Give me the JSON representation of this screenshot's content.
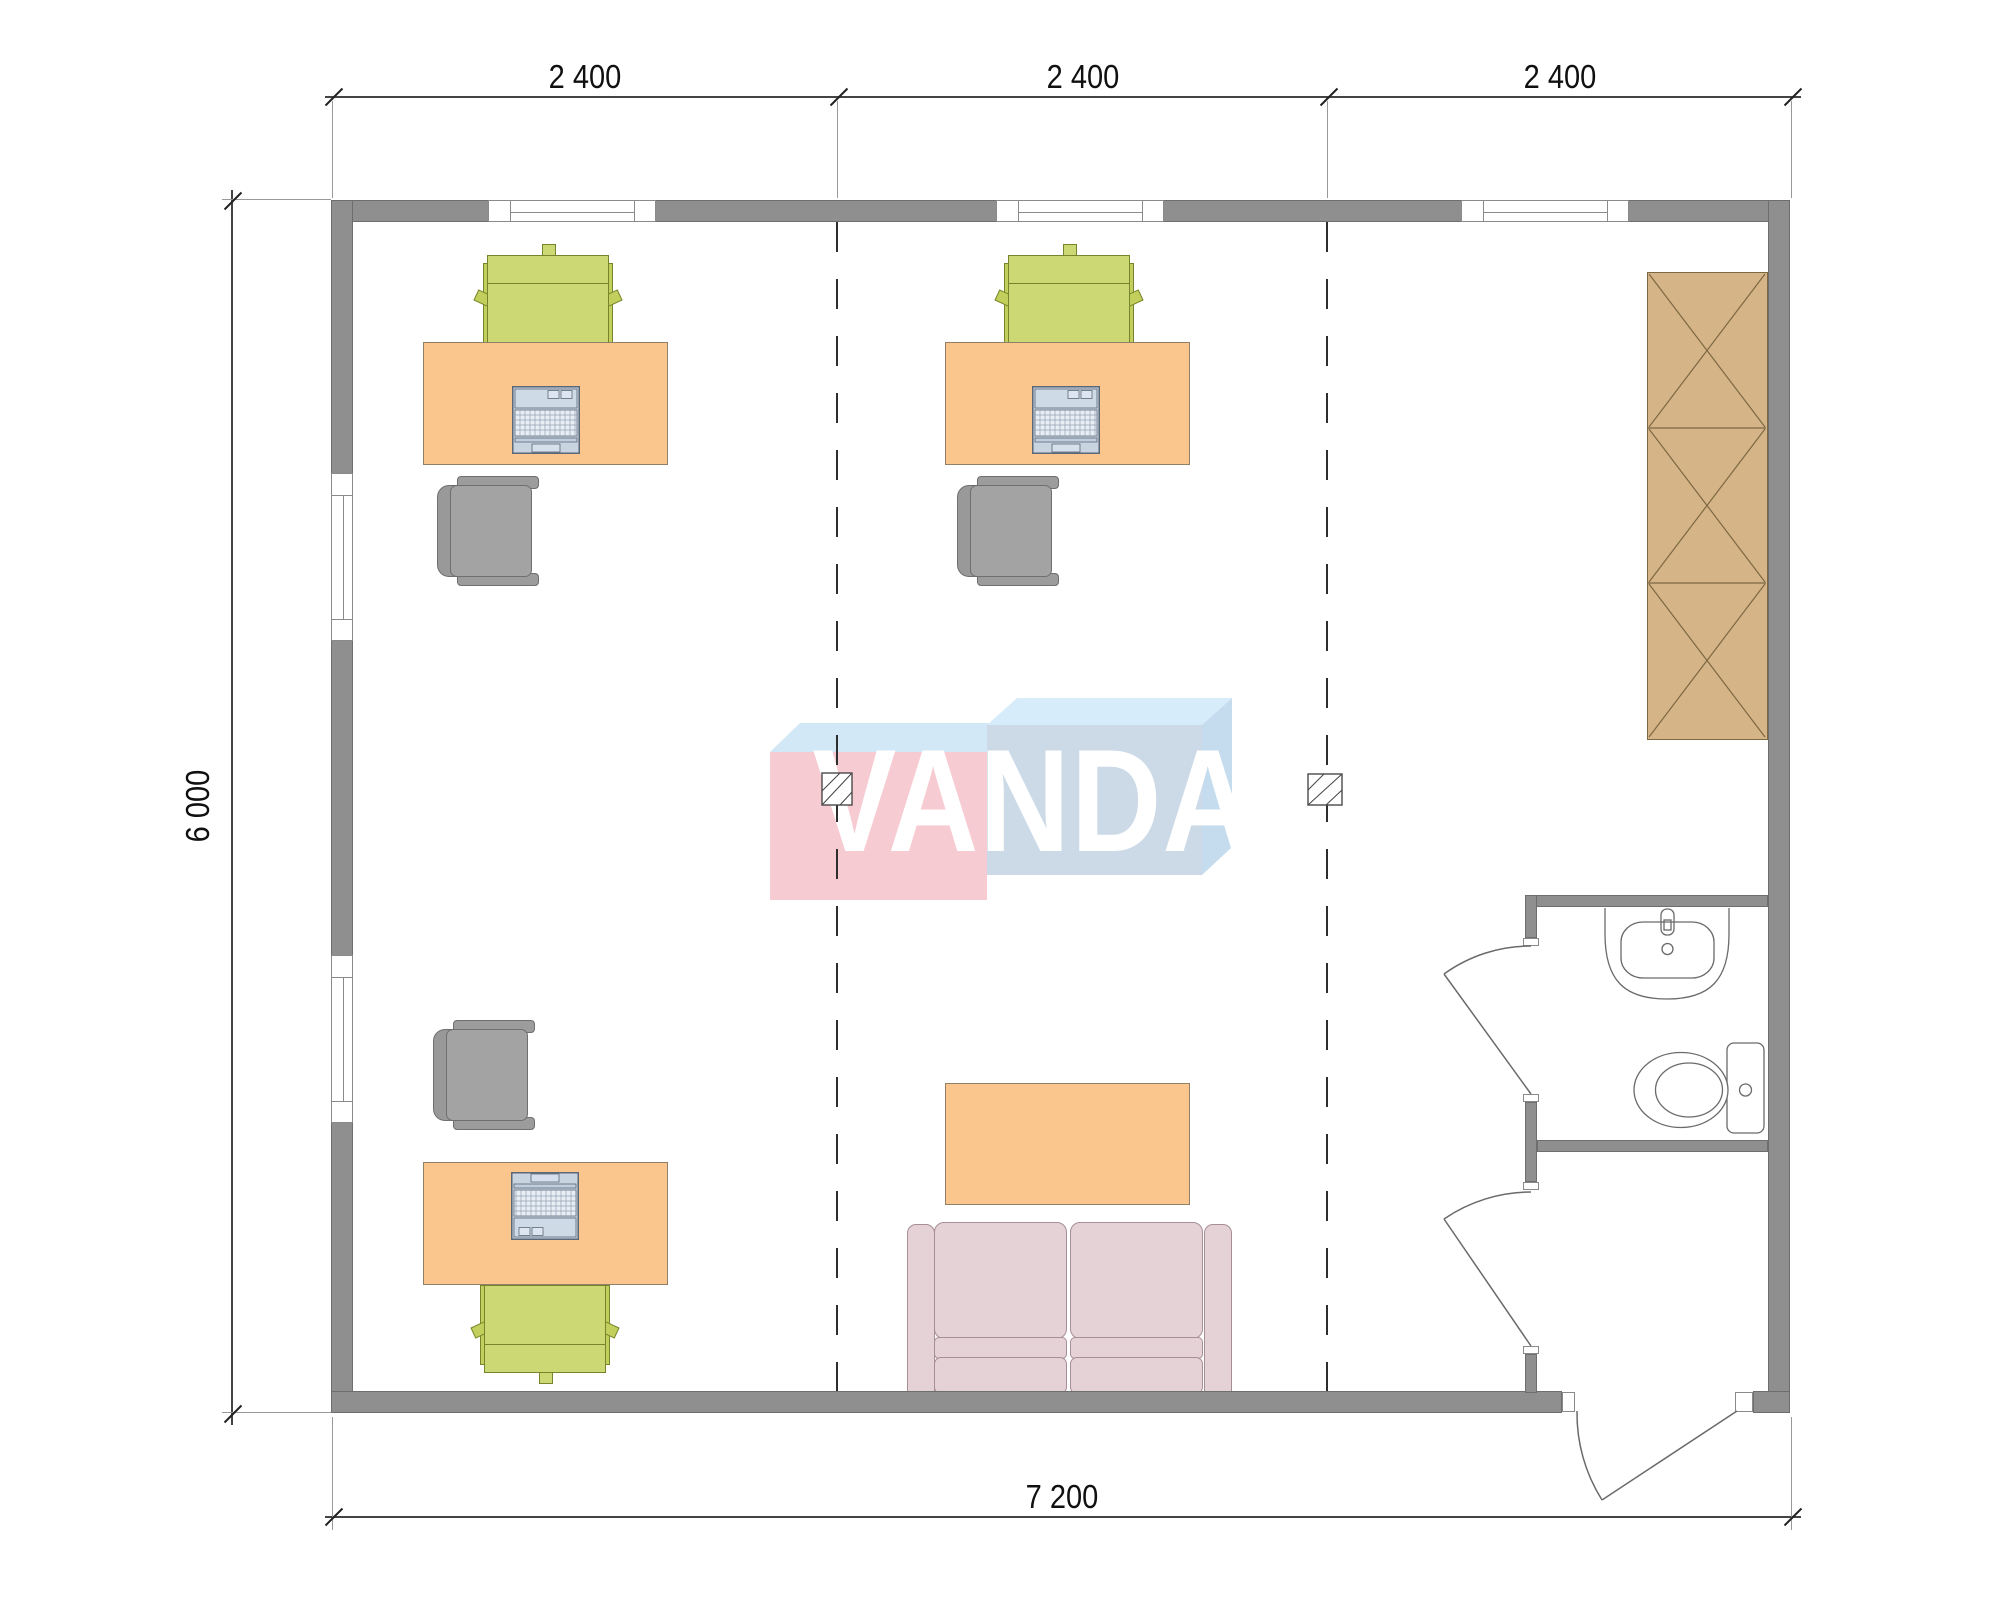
{
  "drawing": {
    "type": "floor-plan",
    "logo_text": "VANDA"
  },
  "dimensions": {
    "top": [
      {
        "label": "2 400"
      },
      {
        "label": "2 400"
      },
      {
        "label": "2 400"
      }
    ],
    "left": {
      "label": "6 000"
    },
    "bottom": {
      "label": "7 200"
    }
  },
  "symbols": [
    "desk",
    "laptop",
    "office-chair",
    "visitor-chair",
    "sofa",
    "coffee-table",
    "wardrobe",
    "sink",
    "toilet",
    "swing-door",
    "window",
    "junction-box",
    "module-grid-line"
  ],
  "colors": {
    "wall": "#8f8f8f",
    "wall-edge": "#6e6e6e",
    "window-frame": "#8a8a8a",
    "desk": "#fac68e",
    "desk-border": "#8f8066",
    "chair-green": "#ccd873",
    "chair-green-dark": "#c3cf5c",
    "chair-green-border": "#76842c",
    "chair-gray": "#9c9c9c",
    "chair-gray-border": "#6f6f6f",
    "sofa": "#e4d2d7",
    "sofa-border": "#a88e96",
    "wardrobe": "#d5b488",
    "wardrobe-border": "#7d6842",
    "laptop": "#c9d4e1",
    "laptop-border": "#5a6878",
    "logo-pink": "#f7cbd2",
    "logo-top-face": "#d2e8f7",
    "logo-blue-front": "#ccd9e7",
    "logo-blue-top": "#d7ecfa",
    "logo-blue-side": "#c4dcee",
    "fixture-line": "#6a6a6a"
  }
}
